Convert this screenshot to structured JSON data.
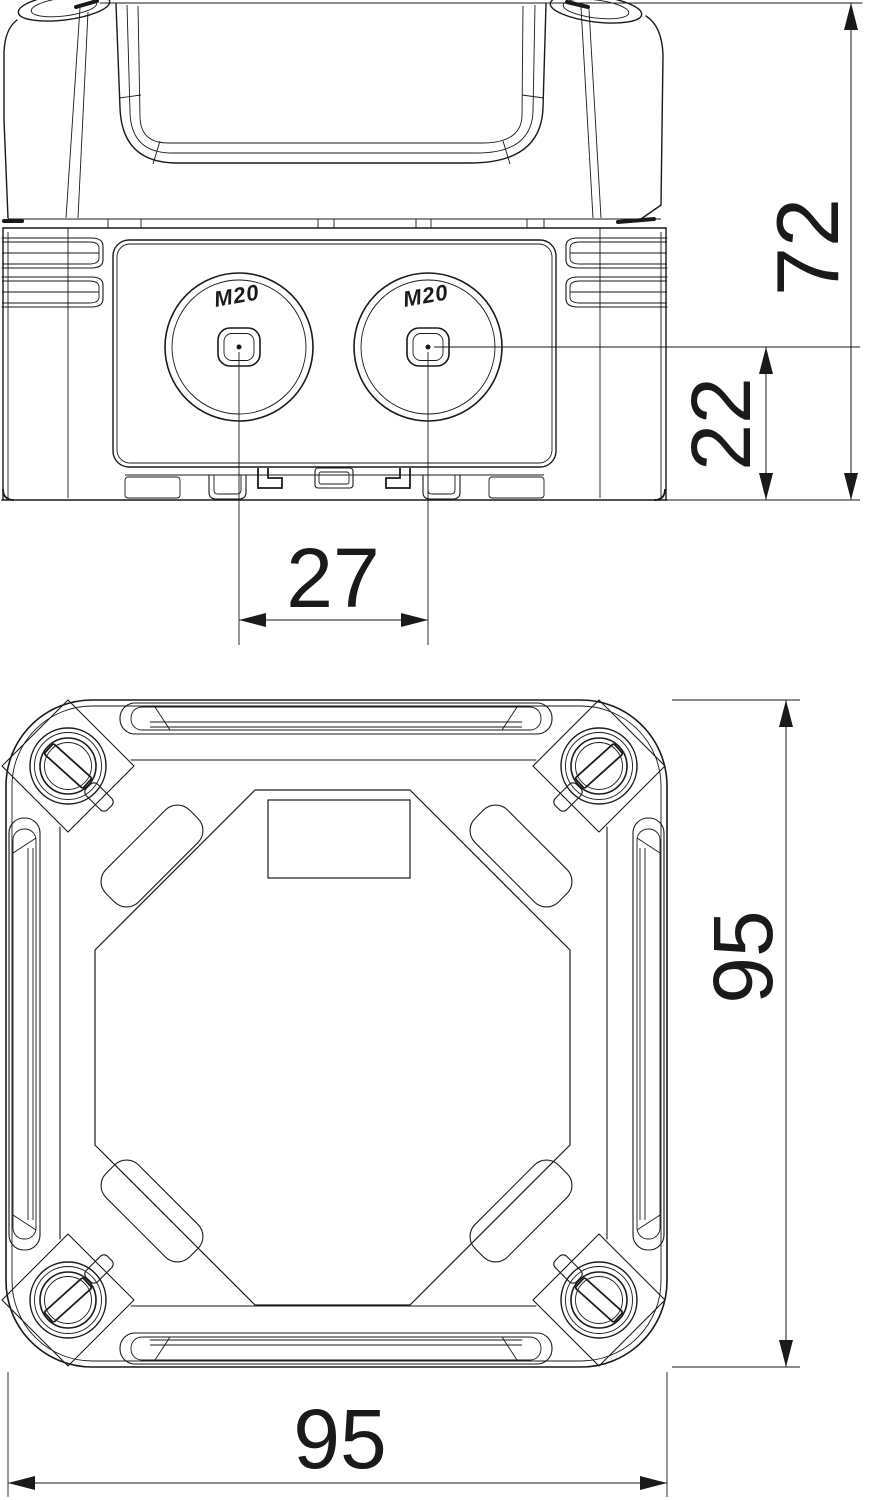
{
  "drawing": {
    "title": "junction-box-dimension-drawing",
    "colors": {
      "line": "#1a1a1a",
      "background": "#ffffff"
    },
    "side_view": {
      "knockouts": [
        {
          "label": "M20"
        },
        {
          "label": "M20"
        }
      ],
      "dimensions": {
        "overall_height": "72",
        "entry_center_height": "22",
        "entry_spacing": "27"
      }
    },
    "plan_view": {
      "dimensions": {
        "overall_width": "95",
        "overall_depth": "95"
      }
    }
  }
}
